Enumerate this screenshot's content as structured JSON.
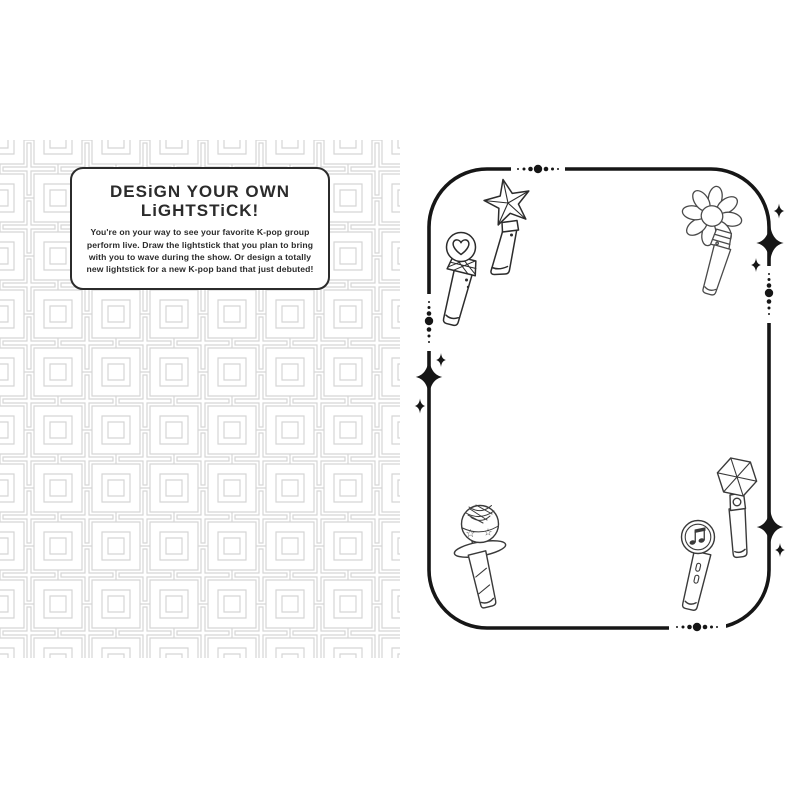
{
  "left_page": {
    "title_line1": "DESiGN YOUR OWN",
    "title_line2": "LiGHTSTiCK!",
    "body_text": "You're on your way to see your favorite K-pop group perform live. Draw the lightstick that you plan to bring with you to wave during the show. Or design a totally new lightstick for a new K-pop band that just debuted!"
  },
  "right_page": {
    "icons": [
      {
        "name": "star-wand-lightstick-icon"
      },
      {
        "name": "heart-mic-lightstick-icon"
      },
      {
        "name": "flower-lightstick-icon"
      },
      {
        "name": "disco-ball-lightstick-icon"
      },
      {
        "name": "hexagon-lightstick-icon"
      },
      {
        "name": "music-note-lightstick-icon"
      },
      {
        "name": "sparkle-icon"
      },
      {
        "name": "dot-divider-icon"
      }
    ]
  },
  "colors": {
    "paper": "#ffffff",
    "ink": "#1a1a1a",
    "pattern_gray": "#d5d5d5",
    "sketch_gray": "#4a4a4a"
  }
}
